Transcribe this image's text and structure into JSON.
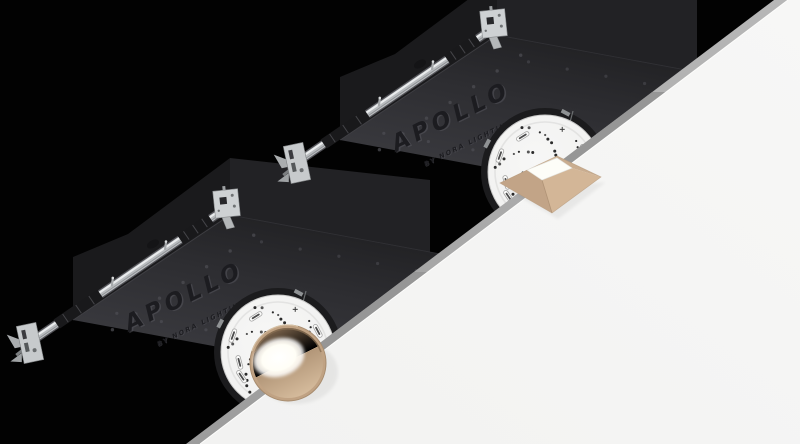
{
  "scene": {
    "background_color": "#020202",
    "ceiling": {
      "surface_color": "#f6f6f5",
      "edge_color": "#a9a9a9",
      "edge_shadow_color": "#969696",
      "edge_highlight_color": "#fdfdfc"
    }
  },
  "branding": {
    "logo_text": "APOLLO",
    "tagline_text": "BY NORA LIGHTING"
  },
  "fixtures": [
    {
      "name": "rear-fixture",
      "trim_shape": "square",
      "trim_finish_color": "#c9ab8d",
      "trim_finish_light_color": "#d8c0a3",
      "lens_color": "#fdfdf8",
      "illuminated": false
    },
    {
      "name": "front-fixture",
      "trim_shape": "round",
      "trim_finish_color": "#c0a283",
      "trim_finish_light_color": "#d6bc9d",
      "lens_color": "#ffffff",
      "illuminated": true
    }
  ],
  "materials": {
    "housing_color": "#2e2e32",
    "housing_dark_color": "#1a1a1c",
    "housing_panel_color": "#222225",
    "engraving_dark_color": "#1c1c20",
    "engraving_light_color": "#55555c",
    "hanger_bar_color": "#b9bcbf",
    "hanger_bar_highlight_color": "#eaeced",
    "hanger_bar_clamp_color": "#19191b",
    "bracket_color": "#c7cacc",
    "flange_color": "#f3f3f2",
    "flange_dot_color": "#2b2b2b",
    "collar_color": "#1b1b1d"
  }
}
